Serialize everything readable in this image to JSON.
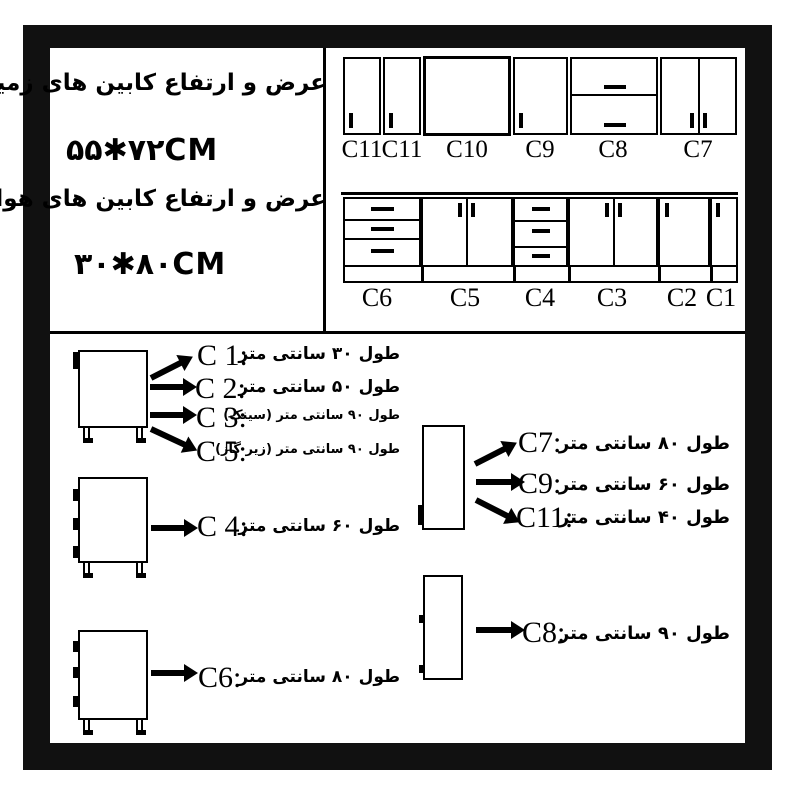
{
  "info": {
    "ground_label": "عرض و ارتفاع کابین های زمینی :",
    "ground_size": "۵۵✱۷۲CM",
    "wall_label": "عرض و ارتفاع کابین های هوایی :",
    "wall_size": "۳۰✱۸۰CM"
  },
  "wall_row_labels": [
    "C11",
    "C11",
    "C10",
    "C9",
    "C8",
    "C7"
  ],
  "base_row_labels": [
    "C6",
    "C5",
    "C4",
    "C3",
    "C2",
    "C1"
  ],
  "legend_left": [
    {
      "code": "C 1:",
      "desc": "طول ۳۰ سانتی متر"
    },
    {
      "code": "C 2:",
      "desc": "طول ۵۰ سانتی متر"
    },
    {
      "code": "C 3:",
      "desc": "طول ۹۰ سانتی متر (سینک)"
    },
    {
      "code": "C 5:",
      "desc": "طول ۹۰ سانتی متر (زیر گاز)"
    },
    {
      "code": "C 4:",
      "desc": "طول ۶۰ سانتی متر"
    },
    {
      "code": "C6:",
      "desc": "طول ۸۰ سانتی متر"
    }
  ],
  "legend_right": [
    {
      "code": "C7:",
      "desc": "طول ۸۰ سانتی متر"
    },
    {
      "code": "C9:",
      "desc": "طول ۶۰ سانتی متر"
    },
    {
      "code": "C11:",
      "desc": "طول ۴۰ سانتی متر"
    },
    {
      "code": "C8:",
      "desc": "طول ۹۰ سانتی متر"
    }
  ],
  "colors": {
    "frame": "#111111",
    "ink": "#000000",
    "background": "#ffffff"
  }
}
